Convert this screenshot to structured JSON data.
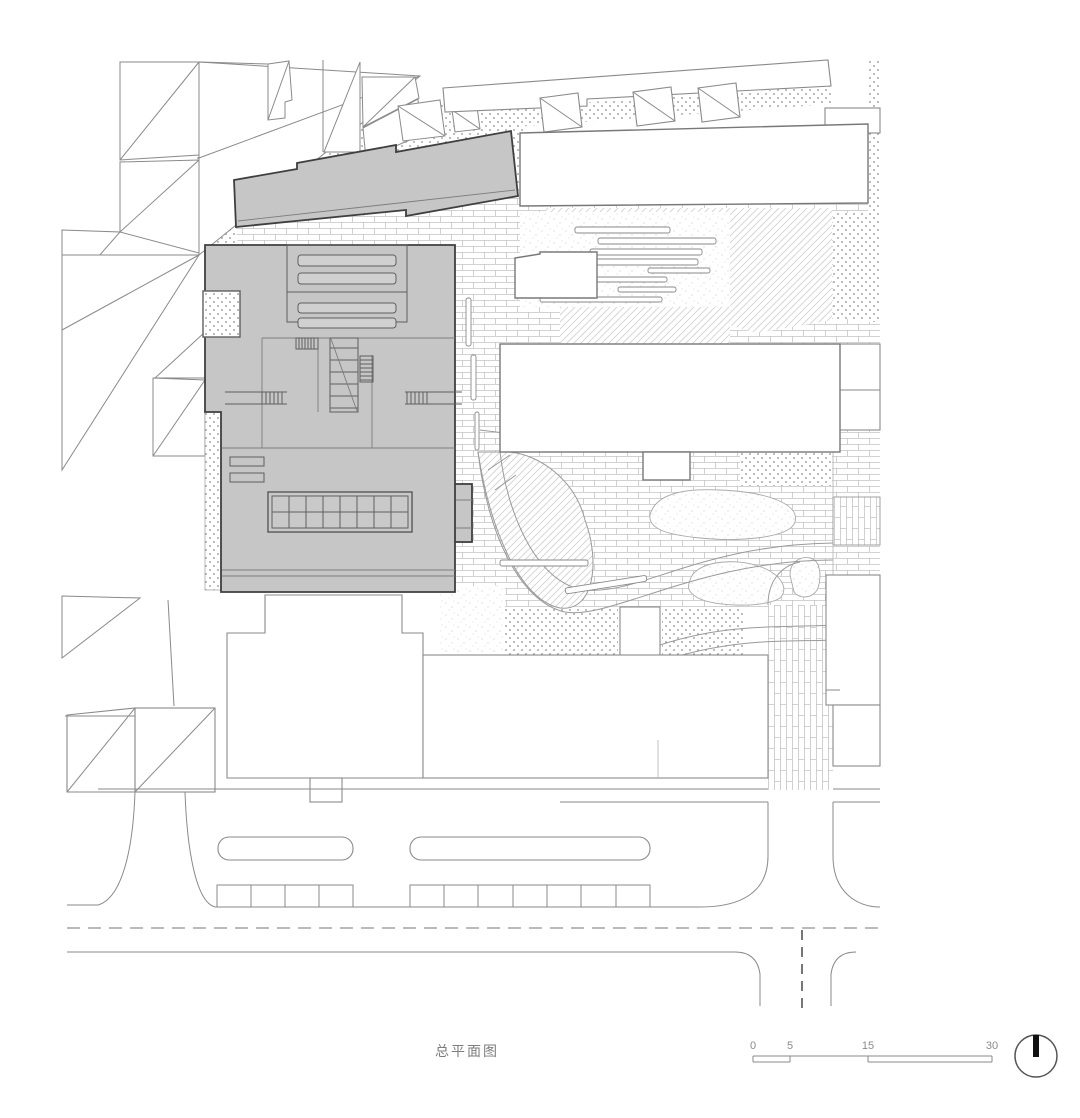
{
  "drawing": {
    "type": "architectural-site-plan",
    "title": "总平面图",
    "scale_bar": {
      "labels": [
        "0",
        "5",
        "15",
        "30"
      ]
    },
    "north_arrow": "circle-with-bar",
    "colors": {
      "background": "#ffffff",
      "proposed_building_fill": "#c6c6c6",
      "proposed_building_outline": "#3f3f3f",
      "context_line": "#8a8a8a",
      "stipple_dot": "#8f8f8f",
      "brick_joint_line": "#c4c4c4",
      "grass_hatch_line": "#d2d2d2",
      "north_arrow_bar": "#111111",
      "label_text": "#7d7d7d"
    }
  }
}
